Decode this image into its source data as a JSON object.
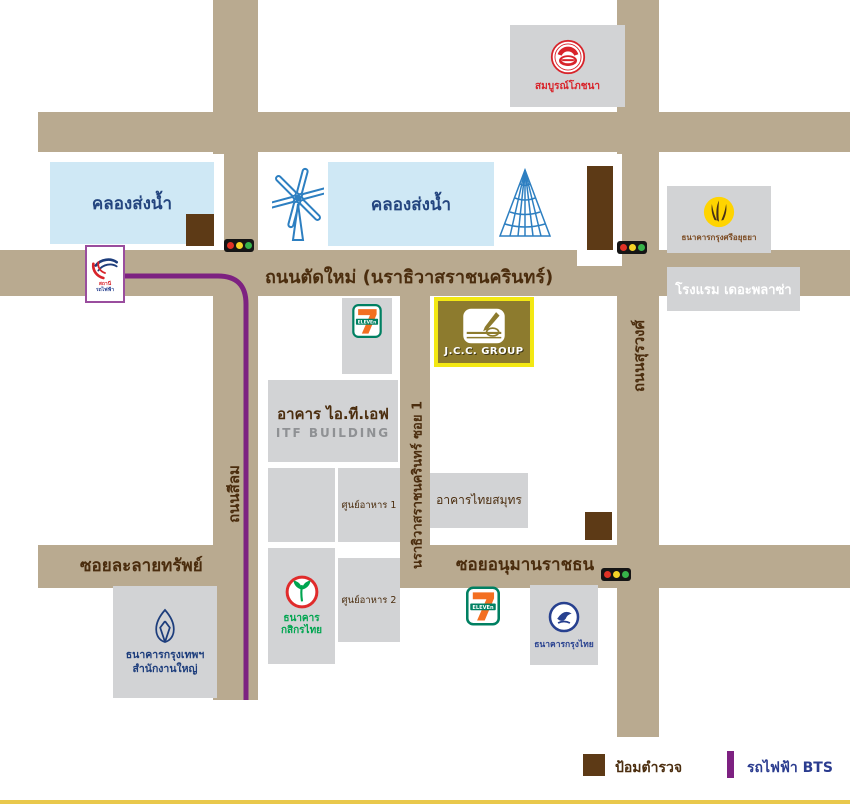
{
  "roads": {
    "main": "ถนนตัดใหม่ (นราธิวาสราชนครินทร์)",
    "silom": "ถนนสีลม",
    "narathiwas_soi1": "นราธิวาสราชนครินทร์ ซอย 1",
    "surawong": "ถนนสุรวงศ์",
    "lalaisap": "ซอยละลายทรัพย์",
    "anuman": "ซอยอนุมานราชธน"
  },
  "canals": {
    "canal1": "คลองส่งน้ำ",
    "canal2": "คลองส่งน้ำ"
  },
  "places": {
    "somboon": "สมบูรณ์โภชนา",
    "krungsri": "ธนาคารกรุงศรีอยุธยา",
    "plaza": "โรงแรม เดอะพลาซ่า",
    "jcc": "J.C.C. GROUP",
    "itf_thai": "อาคาร ไอ.ที.เอฟ",
    "itf_en": "ITF BUILDING",
    "thaisamut": "อาคารไทยสมุทร",
    "foodcourt1": "ศูนย์อาหาร 1",
    "foodcourt2": "ศูนย์อาหาร 2",
    "kbank1": "ธนาคาร",
    "kbank2": "กสิกรไทย",
    "bbl1": "ธนาคารกรุงเทพฯ",
    "bbl2": "สำนักงานใหญ่",
    "ktb": "ธนาคารกรุงไทย",
    "bts_station1": "สถานี",
    "bts_station2": "รถไฟฟ้า",
    "seven_text": "ELEVEn"
  },
  "legend": {
    "police": "ป้อมตำรวจ",
    "bts": "รถไฟฟ้า BTS"
  },
  "icons": {
    "windmill": "blue outline windmill",
    "pyramid": "blue wireframe pyramid",
    "somboon-logo": "red circle restaurant emblem",
    "krungsri-logo": "yellow circle bank emblem",
    "kbank-logo": "red ring with green rice sprout",
    "bbl-logo": "navy lotus outline",
    "ktb-logo": "navy circle bird emblem",
    "seven-eleven-logo": "7-Eleven sign",
    "bts-logo": "red and blue BTS swoosh",
    "traffic-light": "red yellow green dots",
    "police-box": "brown square",
    "bts-line": "purple line"
  },
  "colors": {
    "road": "#b9aa90",
    "building": "#d2d3d5",
    "canal": "#cfe8f5",
    "canal_text": "#24457f",
    "brown_text": "#4b2d0e",
    "police": "#5d3a16",
    "bts_purple": "#7d2181",
    "legend_bts_text": "#2b3c8f",
    "jcc_bg": "#8d7b2e",
    "jcc_border": "#f3e813",
    "seven_green": "#008062",
    "seven_orange": "#f36f21",
    "somboon_red": "#d8232a",
    "krungsri_yellow": "#ffd400",
    "krungsri_text": "#7b4a21",
    "kbank_green": "#00a550",
    "kbank_red": "#e02b2b",
    "bbl_navy": "#1d3d7c",
    "ktb_navy": "#27408f",
    "icon_blue": "#2d7fc1",
    "bottom_line": "#e9c84c",
    "traffic_red": "#e03226",
    "traffic_yellow": "#f5d327",
    "traffic_green": "#37b34a"
  }
}
